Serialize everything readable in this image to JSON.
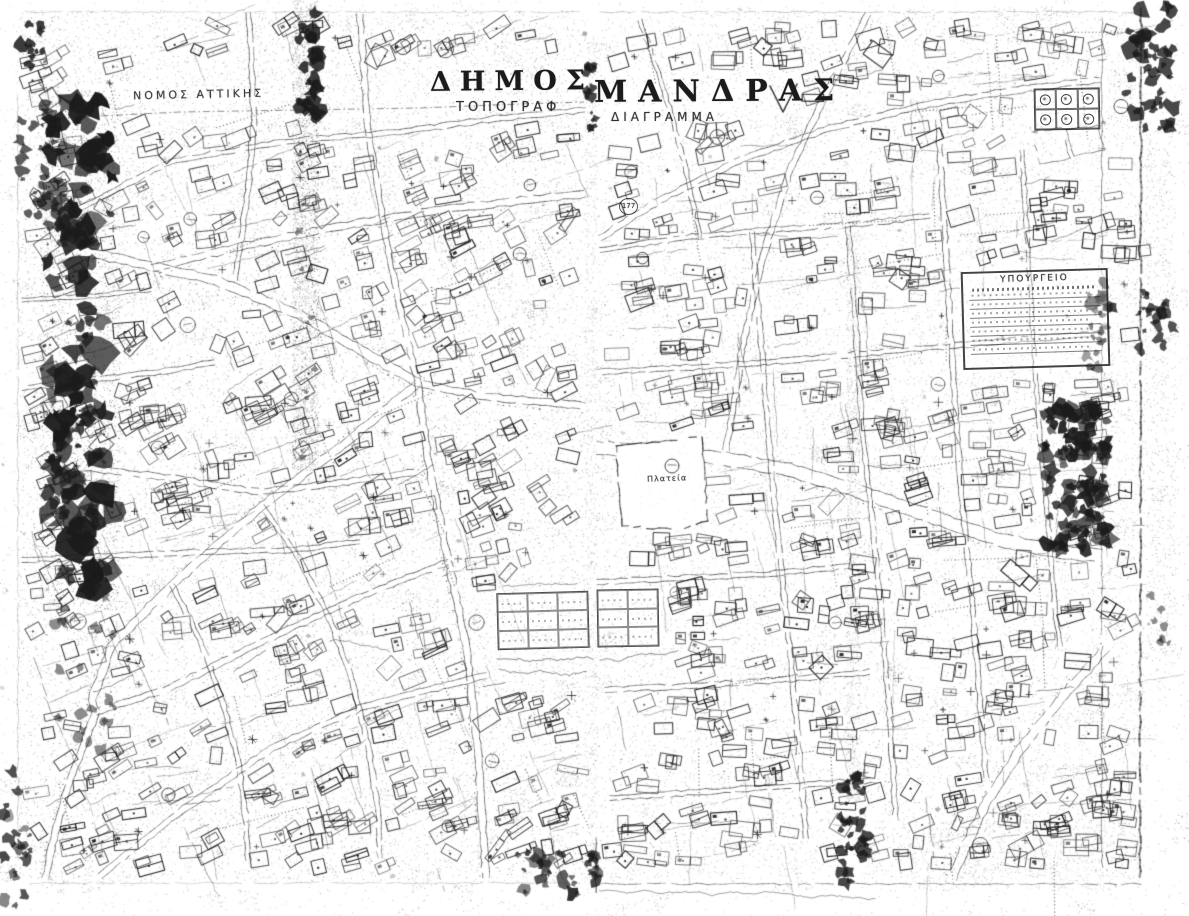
{
  "map": {
    "region_label": "ΝΟΜΟΣ ΑΤΤΙΚΗΣ",
    "title": {
      "left_part": "ΔΗΜΟΣ",
      "right_part": "ΜΑΝΔΡΑΣ",
      "subtitle_left_part": "ΤΟΠΟΓΡΑΦ",
      "subtitle_right_part": "ΔΙΑΓΡΑΜΜΑ"
    },
    "ministry_stamp": {
      "title": "ΥΠΟΥΡΓΕΙΟ"
    },
    "plaza": {
      "label": "Πλατεία"
    },
    "block_numbers": {
      "b177": "177"
    },
    "colors": {
      "paper": "#ffffff",
      "ink": "#1b1b1b"
    }
  }
}
